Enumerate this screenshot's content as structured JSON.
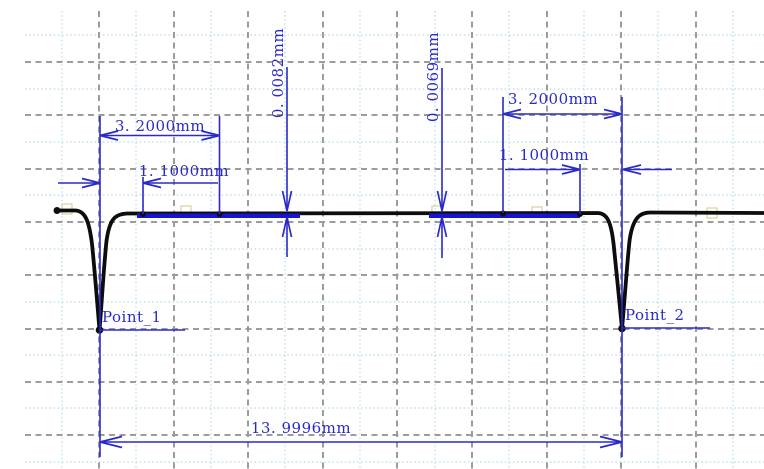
{
  "canvas": {
    "width": 764,
    "height": 469,
    "background": "#ffffff"
  },
  "colors": {
    "dimension_blue": "#2a2ac8",
    "overlay_blue": "#1515d2",
    "profile_black": "#0d0d0d",
    "grid_major": "#9c9c9c",
    "grid_minor": "#b6d9e8",
    "marker_khaki": "#d6d39c"
  },
  "labels": {
    "left_3_2": "3. 2000mm",
    "left_1_1": "1. 1000mm",
    "step_left": "0. 0082mm",
    "step_right": "0. 0069mm",
    "right_3_2": "3. 2000mm",
    "right_1_1": "1. 1000mm",
    "total": "13. 9996mm",
    "point1": "Point_1",
    "point2": "Point_2"
  },
  "chart_data": {
    "type": "line",
    "title": "",
    "xlabel": "",
    "ylabel": "",
    "x_unit": "mm",
    "axes_visible": false,
    "grid": "gray dashed major grid with light-blue dotted minor grid",
    "series": [
      {
        "name": "surface-profile-trace",
        "color": "#0d0d0d",
        "points_px": [
          [
            57,
            210
          ],
          [
            76,
            210
          ],
          [
            92,
            244
          ],
          [
            99,
            330
          ],
          [
            106,
            241
          ],
          [
            126,
            214
          ],
          [
            598,
            213
          ],
          [
            614,
            245
          ],
          [
            622,
            329
          ],
          [
            629,
            241
          ],
          [
            648,
            212
          ],
          [
            764,
            213
          ]
        ]
      },
      {
        "name": "fitted-reference-segments",
        "color": "#1515d2",
        "y_px": 216,
        "segments_px": [
          [
            137,
            300
          ],
          [
            429,
            580
          ]
        ]
      }
    ],
    "annotations": [
      {
        "label": "Point_1",
        "x_px": 100,
        "type": "point-marker"
      },
      {
        "label": "Point_2",
        "x_px": 622,
        "type": "point-marker"
      },
      {
        "label": "3. 2000mm",
        "value_mm": 3.2,
        "side": "left",
        "span_px": [
          100,
          219
        ]
      },
      {
        "label": "1. 1000mm",
        "value_mm": 1.1,
        "side": "left",
        "span_px": [
          100,
          143
        ]
      },
      {
        "label": "0. 0082mm",
        "value_mm": 0.0082,
        "orientation": "vertical",
        "x_px": 287
      },
      {
        "label": "0. 0069mm",
        "value_mm": 0.0069,
        "orientation": "vertical",
        "x_px": 442
      },
      {
        "label": "3. 2000mm",
        "value_mm": 3.2,
        "side": "right",
        "span_px": [
          503,
          622
        ]
      },
      {
        "label": "1. 1000mm",
        "value_mm": 1.1,
        "side": "right",
        "span_px": [
          580,
          622
        ]
      },
      {
        "label": "13. 9996mm",
        "value_mm": 13.9996,
        "measures": "Point_1 to Point_2",
        "span_px": [
          100,
          622
        ]
      }
    ]
  },
  "geometry": {
    "grid": {
      "v_minor": [
        62,
        136,
        211,
        285,
        360,
        435,
        509,
        584,
        658,
        733
      ],
      "v_major": [
        99,
        174,
        248,
        323,
        397,
        472,
        547,
        621,
        696
      ],
      "h_minor": [
        35,
        89,
        142,
        195,
        249,
        302,
        355,
        408,
        462
      ],
      "h_major": [
        62,
        115,
        169,
        222,
        275,
        329,
        382,
        435
      ],
      "v_span": [
        11,
        469
      ],
      "h_span": [
        25,
        764
      ]
    },
    "markers": [
      [
        67,
        209
      ],
      [
        186,
        211
      ],
      [
        437,
        211
      ],
      [
        537,
        212
      ],
      [
        712,
        213
      ]
    ],
    "profile_path": "M57,210.5 L76,210.5 C85,211.5 89,220 92,244 C94.5,268 97.5,306 99.5,330 C101.5,306 104,264 106.5,241 C109.5,219 115,214 127,213.5 L598,213 C607,213.5 611,221 613.7,245 C616.2,269 619.8,306 622,328.5 C624.2,306 627,264 629.5,241 C632.5,219 639,212.5 650,212.5 L764,213",
    "overlays": [
      [
        137,
        215.8,
        300
      ],
      [
        429,
        215.8,
        580
      ]
    ],
    "dots": [
      [
        57,
        210.5,
        3.5
      ],
      [
        99.5,
        330,
        3.8
      ],
      [
        143,
        214,
        3
      ],
      [
        219.5,
        214,
        3
      ],
      [
        503,
        213.5,
        3
      ],
      [
        580,
        214,
        3
      ],
      [
        622,
        328.5,
        3.8
      ]
    ],
    "dim_lines": [
      [
        100,
        116,
        100,
        457
      ],
      [
        219.5,
        116,
        219.5,
        214
      ],
      [
        143,
        177,
        143,
        214
      ],
      [
        503,
        97,
        503,
        213
      ],
      [
        622,
        97,
        622,
        457
      ],
      [
        580,
        164,
        580,
        214
      ],
      [
        100,
        135.5,
        219.5,
        135.5
      ],
      [
        58,
        183,
        100,
        183
      ],
      [
        143,
        183,
        218,
        183
      ],
      [
        503,
        114,
        622,
        114
      ],
      [
        505,
        169.5,
        580,
        169.5
      ],
      [
        623,
        169.5,
        672,
        169.5
      ],
      [
        100,
        442,
        622,
        442
      ],
      [
        287,
        67,
        287,
        209
      ],
      [
        287,
        219,
        287,
        257
      ],
      [
        442,
        68,
        442,
        209
      ],
      [
        442,
        219,
        442,
        258
      ],
      [
        99,
        330,
        185,
        330
      ],
      [
        622,
        328,
        710,
        328
      ]
    ],
    "arrows": [
      [
        118,
        131,
        100,
        135.5,
        118,
        140
      ],
      [
        201.5,
        131,
        219.5,
        135.5,
        201.5,
        140
      ],
      [
        82,
        178.5,
        100,
        183,
        82,
        187.5
      ],
      [
        161,
        178.5,
        143,
        183,
        161,
        187.5
      ],
      [
        521,
        109.5,
        503,
        114,
        521,
        118.5
      ],
      [
        604,
        109.5,
        622,
        114,
        604,
        118.5
      ],
      [
        562,
        165,
        580,
        169.5,
        562,
        174
      ],
      [
        641,
        165,
        623,
        169.5,
        641,
        174
      ],
      [
        282.5,
        191,
        287,
        211,
        291.5,
        191
      ],
      [
        282.5,
        237,
        287,
        217,
        291.5,
        237
      ],
      [
        437.5,
        191,
        442,
        211,
        446.5,
        191
      ],
      [
        437.5,
        237,
        442,
        217,
        446.5,
        237
      ],
      [
        122,
        436.5,
        100,
        442,
        122,
        447.5
      ],
      [
        600,
        436.5,
        622,
        442,
        600,
        447.5
      ]
    ]
  }
}
